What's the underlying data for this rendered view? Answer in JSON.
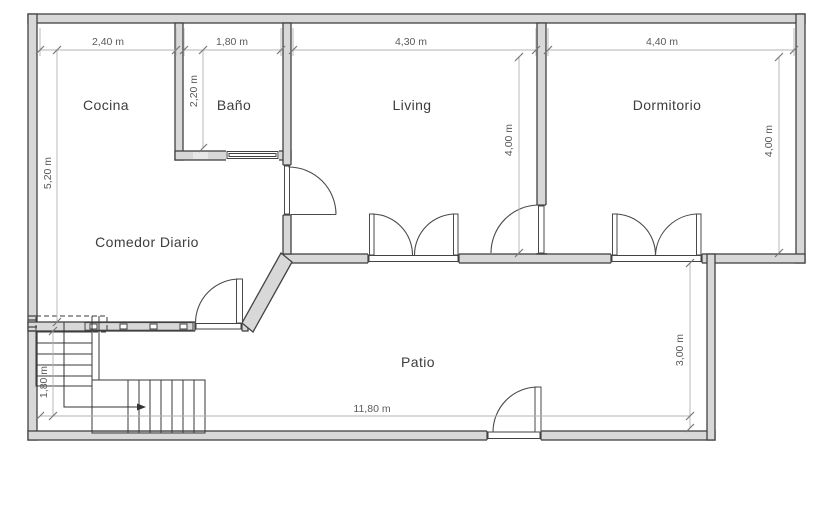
{
  "drawing": {
    "type": "architectural-floor-plan",
    "rooms": {
      "cocina": {
        "label": "Cocina"
      },
      "bano": {
        "label": "Baño"
      },
      "living": {
        "label": "Living"
      },
      "dormitorio": {
        "label": "Dormitorio"
      },
      "comedor": {
        "label": "Comedor Diario"
      },
      "patio": {
        "label": "Patio"
      }
    },
    "dimensions": {
      "cocina_width": {
        "label": "2,40 m"
      },
      "bano_width": {
        "label": "1,80 m"
      },
      "living_width": {
        "label": "4,30 m"
      },
      "dormitorio_width": {
        "label": "4,40 m"
      },
      "bano_depth": {
        "label": "2,20 m"
      },
      "west_wing_depth": {
        "label": "5,20 m"
      },
      "living_depth": {
        "label": "4,00 m"
      },
      "dormitorio_depth": {
        "label": "4,00 m"
      },
      "patio_depth": {
        "label": "3,00 m"
      },
      "patio_width": {
        "label": "11,80 m"
      },
      "stairs_width": {
        "label": "1,80 m"
      }
    },
    "colors": {
      "wall_fill": "#d8d8d8",
      "wall_stroke": "#424242",
      "dimension_line": "#b3b3b3",
      "dimension_text": "#5a5a5a",
      "room_text": "#3d3d3d",
      "background": "#ffffff"
    }
  }
}
